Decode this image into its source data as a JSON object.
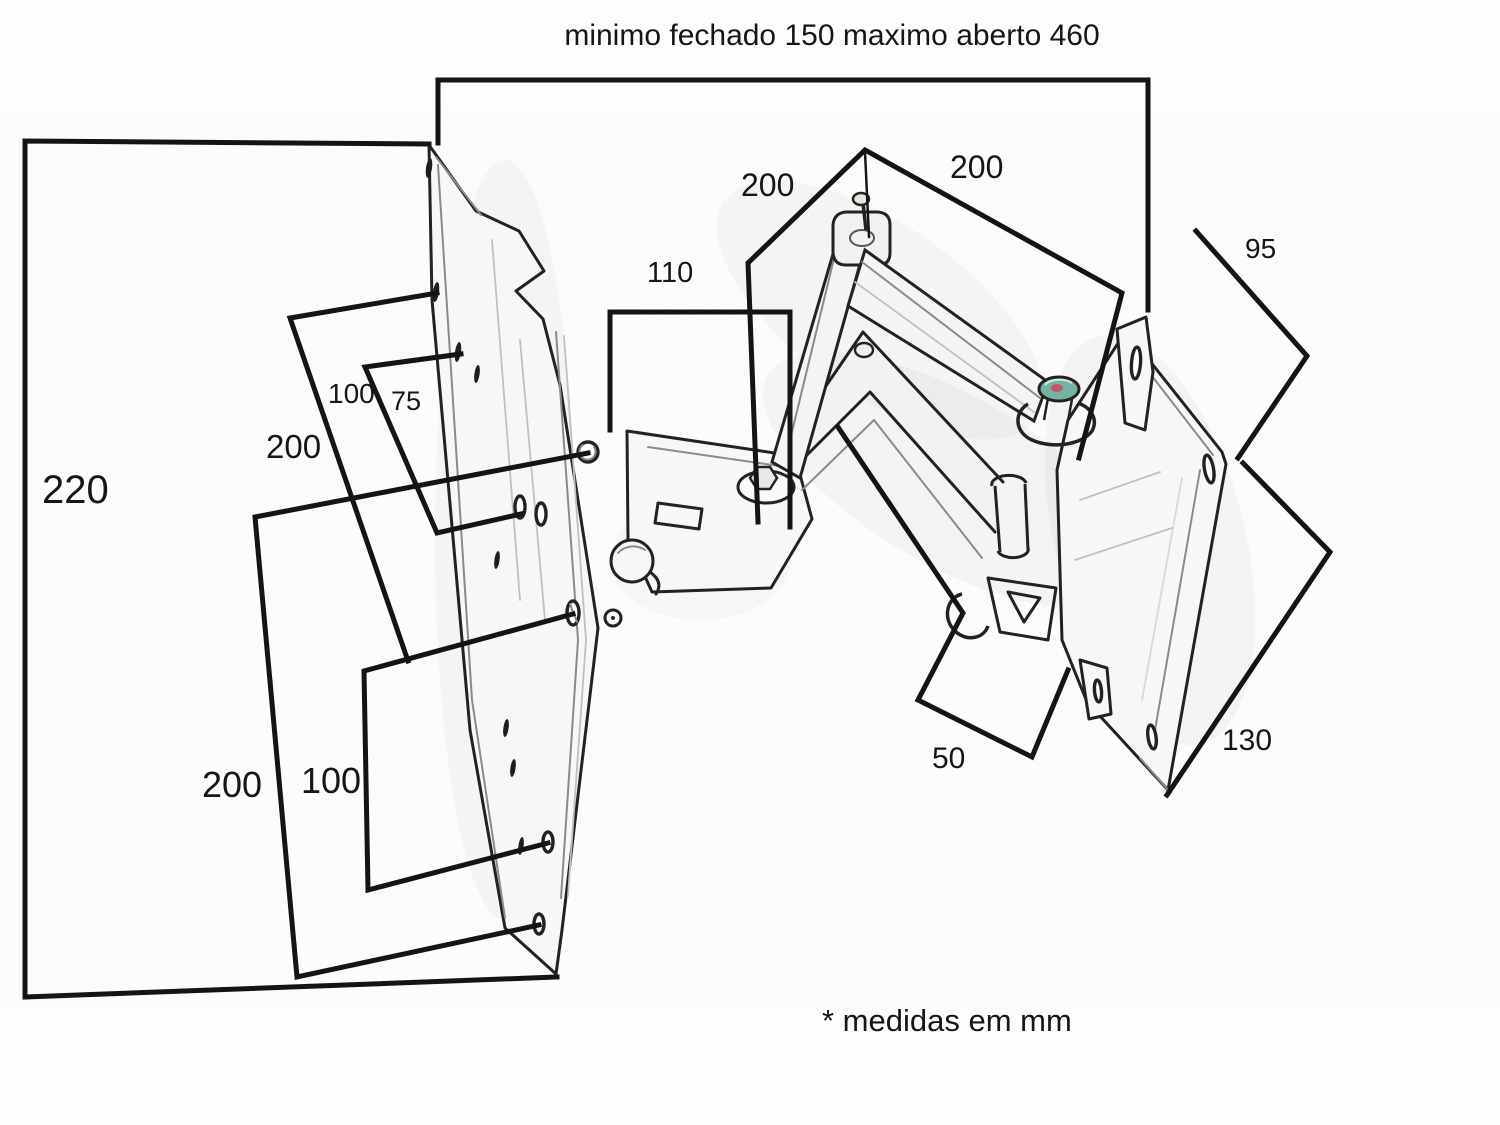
{
  "title": "minimo fechado 150 maximo aberto 460",
  "footnote": "* medidas em mm",
  "dims": {
    "plate_height": "220",
    "upper_hole_spacing_100": "100",
    "upper_hole_spacing_75": "75",
    "upper_span_200": "200",
    "lower_span_200": "200",
    "lower_hole_spacing_100": "100",
    "bracket_110": "110",
    "arm_left_200": "200",
    "arm_right_200": "200",
    "vesa_95": "95",
    "vesa_130": "130",
    "fork_50": "50"
  },
  "colors": {
    "dimension_line": "#141414",
    "sketch_dark": "#222220",
    "sketch_light": "#8a8a8a",
    "paper": "#fdfdfc",
    "bolt_teal": "#74b3a3",
    "bolt_red": "#c2566e"
  }
}
